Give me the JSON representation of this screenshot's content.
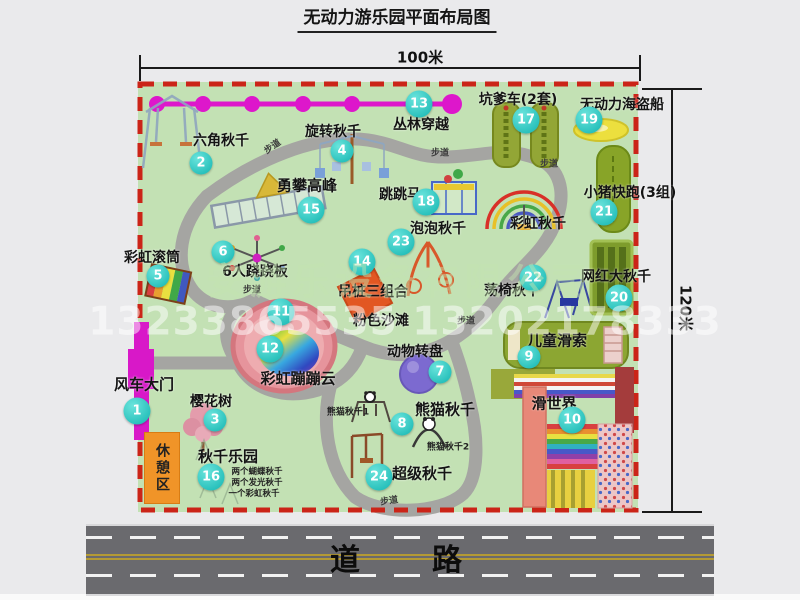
{
  "title": "无动力游乐园平面布局图",
  "dimensions": {
    "width": "100米",
    "height": "120米"
  },
  "watermark": {
    "company": "安游乐设备有限公司",
    "phone": "13233865535 13202178333"
  },
  "road_label": "道　　路",
  "trail_label": "步道",
  "rest_area_label": "休憩区",
  "rainbow_swing_label": "彩虹秋千",
  "colors": {
    "map_green": "#c3e1b4",
    "border_red": "#cb2418",
    "marker_teal": "#14b6b2",
    "zipline_magenta": "#dd17cb",
    "gate_magenta": "#d818c8",
    "road_gray": "#6a6a6e",
    "rest_orange": "#f09428"
  },
  "pois": {
    "p1": {
      "num": "1",
      "label": "风车大门"
    },
    "p2": {
      "num": "2",
      "label": "六角秋千"
    },
    "p3": {
      "num": "3",
      "label": "樱花树"
    },
    "p4": {
      "num": "4",
      "label": "旋转秋千"
    },
    "p5": {
      "num": "5",
      "label": "彩虹滚筒"
    },
    "p6": {
      "num": "6",
      "label": "6人跷跷板"
    },
    "p7": {
      "num": "7",
      "label": "动物转盘"
    },
    "p8": {
      "num": "8",
      "label": "熊猫秋千",
      "sub1": "熊猫秋千1",
      "sub2": "熊猫秋千2"
    },
    "p9": {
      "num": "9",
      "label": "儿童滑索"
    },
    "p10": {
      "num": "10",
      "label": "滑世界"
    },
    "p11": {
      "num": "11",
      "label": "粉色沙滩"
    },
    "p12": {
      "num": "12",
      "label": "彩虹蹦蹦云"
    },
    "p13": {
      "num": "13",
      "label": "丛林穿越"
    },
    "p14": {
      "num": "14",
      "label": "吊桩三组合"
    },
    "p15": {
      "num": "15",
      "label": "勇攀高峰"
    },
    "p16": {
      "num": "16",
      "label": "秋千乐园",
      "note1": "两个蝴蝶秋千",
      "note2": "两个发光秋千",
      "note3": "一个彩虹秋千"
    },
    "p17": {
      "num": "17",
      "label": "坑爹车(2套)"
    },
    "p18": {
      "num": "18",
      "label": "跳跳马"
    },
    "p19": {
      "num": "19",
      "label": "无动力海盗船"
    },
    "p20": {
      "num": "20",
      "label": "网红大秋千"
    },
    "p21": {
      "num": "21",
      "label": "小猪快跑(3组)"
    },
    "p22": {
      "num": "22",
      "label": "荡椅秋千"
    },
    "p23": {
      "num": "23",
      "label": "泡泡秋千"
    },
    "p24": {
      "num": "24",
      "label": "超级秋千"
    }
  }
}
